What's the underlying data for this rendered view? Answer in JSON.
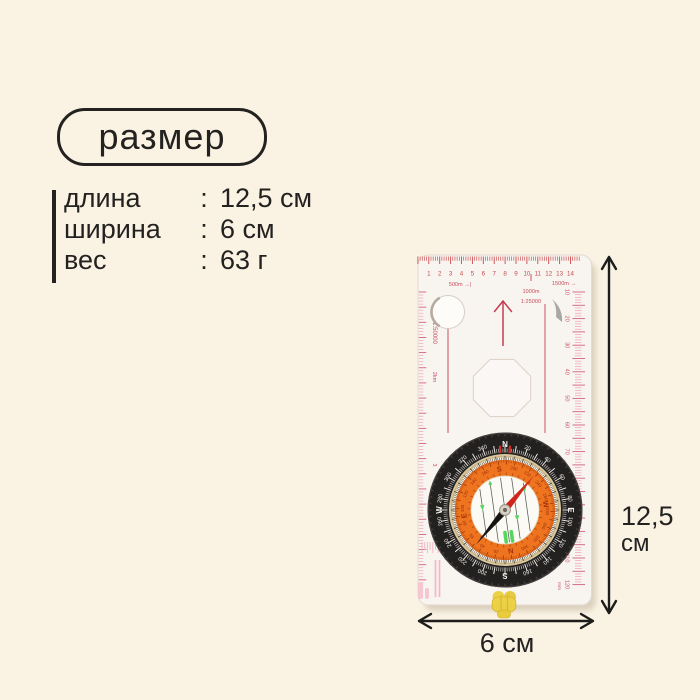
{
  "colors": {
    "background": "#faf3e4",
    "text": "#232220",
    "arrow": "#1d1d1b",
    "ruler_red": "#c84a4a",
    "scale_text": "#c8505e",
    "scale_pink": "#eda4b4",
    "scale_pink_dark": "#d4607a",
    "orange": "#ee7420",
    "bezel_black": "#232020",
    "needle_red": "#d0251c",
    "needle_black": "#161412",
    "luminous_green": "#55d65c",
    "whistle_yellow": "#ecd041"
  },
  "badge": {
    "label": "размер"
  },
  "specs": {
    "rows": [
      {
        "label": "длина",
        "colon": ":",
        "value": "12,5 см"
      },
      {
        "label": "ширина",
        "colon": ":",
        "value": "6 см"
      },
      {
        "label": "вес",
        "colon": ":",
        "value": "63 г"
      }
    ]
  },
  "dimension_labels": {
    "height_value": "12,5",
    "height_unit": "см",
    "width": "6 см"
  },
  "compass": {
    "top_ruler": {
      "numbers": [
        "1",
        "2",
        "3",
        "4",
        "5",
        "6",
        "7",
        "8",
        "9",
        "10",
        "11",
        "12",
        "13",
        "14"
      ]
    },
    "scales": {
      "left": "500m →|",
      "center_line1": "1000m",
      "center_line2": "1:25000",
      "right": "1500m →"
    },
    "left_edge": {
      "scale": "1:50000",
      "sub": "2km",
      "num": "3"
    },
    "right_ruler": {
      "numbers": [
        "10",
        "20",
        "30",
        "40",
        "50",
        "60",
        "70",
        "80",
        "90",
        "100",
        "110",
        "120"
      ],
      "unit": "mm"
    },
    "bezel": {
      "cardinals": {
        "0": "N",
        "90": "E",
        "180": "S",
        "270": "W"
      },
      "numbers": [
        "20",
        "40",
        "60",
        "80",
        "100",
        "120",
        "140",
        "160",
        "200",
        "220",
        "240",
        "260",
        "280",
        "300",
        "320",
        "340"
      ]
    },
    "dial": {
      "rotation_deg": 172,
      "needle_deg": 40,
      "cardinals": {
        "0": "N",
        "90": "E",
        "180": "S",
        "270": "W"
      },
      "numbers": [
        "20",
        "40",
        "60",
        "80",
        "100",
        "120",
        "140",
        "160",
        "200",
        "220",
        "240",
        "260",
        "280",
        "300",
        "320",
        "340"
      ]
    }
  }
}
